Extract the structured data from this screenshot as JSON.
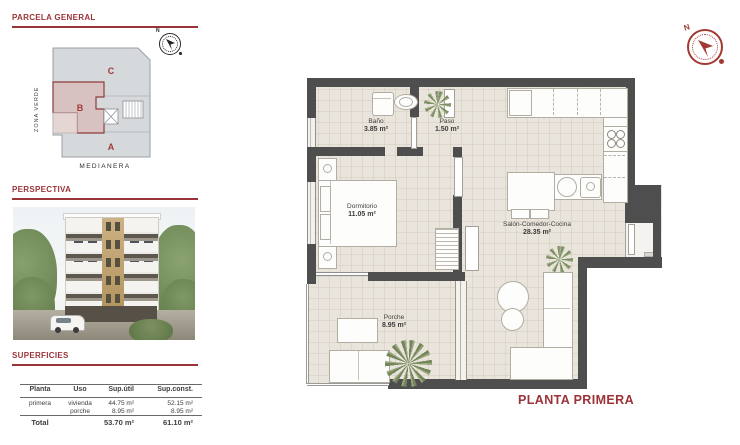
{
  "sidebar": {
    "parcela": {
      "title": "PARCELA GENERAL",
      "zone_a": "A",
      "zone_b": "B",
      "zone_c": "C",
      "zona_verde": "ZONA VERDE",
      "medianera": "MEDIANERA",
      "compass_n": "N"
    },
    "perspectiva": {
      "title": "PERSPECTIVA"
    },
    "superficies": {
      "title": "SUPERFICIES",
      "table": {
        "col_planta": "Planta",
        "col_uso": "Uso",
        "col_sup_util": "Sup.útil",
        "col_sup_const": "Sup.const.",
        "row": {
          "planta": "primera",
          "uso_1": "vivienda",
          "uso_2": "porche",
          "util_1": "44.75 m²",
          "util_2": "8.95 m²",
          "const_1": "52.15 m²",
          "const_2": "8.95 m²"
        },
        "total": {
          "label": "Total",
          "util": "53.70 m²",
          "const": "61.10 m²"
        }
      }
    }
  },
  "plan": {
    "title": "PLANTA PRIMERA",
    "compass_n": "N",
    "rooms": {
      "bano": {
        "name": "Baño",
        "area": "3.85 m²"
      },
      "paso": {
        "name": "Paso",
        "area": "1.50 m²"
      },
      "dormitorio": {
        "name": "Dormitorio",
        "area": "11.05 m²"
      },
      "salon": {
        "name": "Salón-Comedor-Cocina",
        "area": "28.35 m²"
      },
      "porche": {
        "name": "Porche",
        "area": "8.95 m²"
      }
    }
  },
  "colors": {
    "accent": "#9c3338",
    "wall": "#4e4e4e",
    "floor": "#eae5dc",
    "parcela_fill": "#d6d9dc",
    "parcela_b_fill": "#d8c2c1"
  }
}
